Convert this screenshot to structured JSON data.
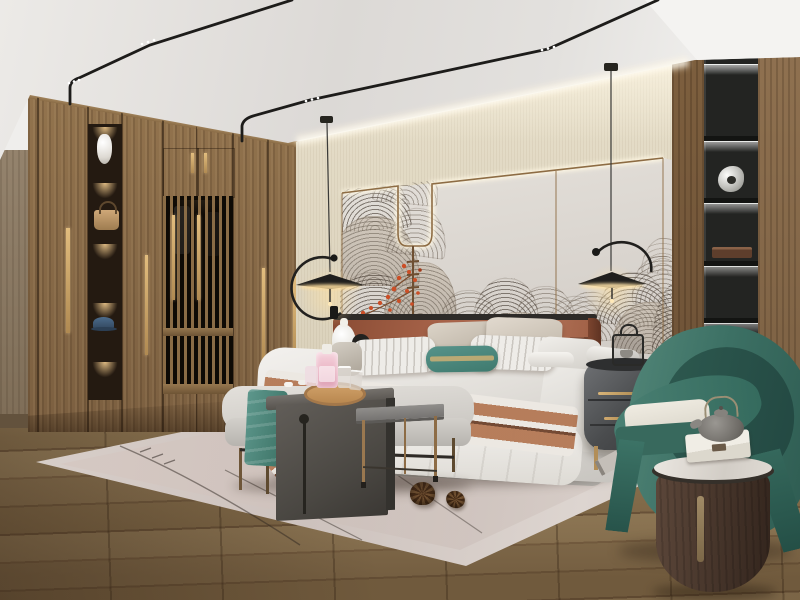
{
  "scene": {
    "title": "Modern Chinese style bedroom interior",
    "room": "bedroom",
    "style": "new Chinese / japandi",
    "lighting": "warm cove LED and black track lighting"
  },
  "objects": {
    "ceiling": {
      "label": "recessed white ceiling with black magnetic track lights"
    },
    "track_lighting": {
      "label": "thin black track lights with LED spots",
      "count": 2
    },
    "cove_light": {
      "label": "warm LED cove light above feature wall"
    },
    "wardrobe": {
      "label": "full-height walnut wardrobe wall",
      "handle_color": "#c9a96a"
    },
    "display_shelf": {
      "label": "red-backed display niches",
      "items": [
        "white ceramic vase",
        "tan leather handbag",
        "blue cap"
      ],
      "niche_count": 5
    },
    "lattice_doors": {
      "label": "wood lattice sliding doors with clothes behind"
    },
    "feature_wall": {
      "label": "cream padded wall panels with brass trim",
      "mural": "ink wave-cloud mural with red blossom sprigs",
      "panel_color": "#ddd8d2"
    },
    "pendant_lamp_left": {
      "label": "black disc pendant lamp with ring arm"
    },
    "pendant_lamp_right": {
      "label": "black disc pendant lamp with arc arm"
    },
    "bed": {
      "label": "upholstered platform bed with white duvet"
    },
    "headboard": {
      "label": "caramel leather panel headboard",
      "color": "#a8644a"
    },
    "pillows": {
      "label": "layered pillows",
      "accent_pillow_color": "#4f8a7e",
      "accent": "teal lumbar pillow with gold band"
    },
    "throw_runner": {
      "label": "caramel and white striped bed runner"
    },
    "nightstand_left": {
      "label": "black round nightstand"
    },
    "table_lamp": {
      "label": "white gourd ceramic lamp and small black lamp"
    },
    "nightstand_right": {
      "label": "gray oval nightstand with brass handles"
    },
    "lantern_decor": {
      "label": "black wire lantern ornament"
    },
    "bench": {
      "label": "light gray bed-end bench on bronze legs"
    },
    "teal_throw": {
      "label": "teal throw blanket"
    },
    "arch_side_table": {
      "label": "dark gray arch side table with cutout slot"
    },
    "tray_set": {
      "label": "round wood tray with pink perfume bottles and glasses"
    },
    "metal_side_table": {
      "label": "gray metal C-table with thin bronze legs"
    },
    "rug": {
      "label": "pale greige area rug with thin line motif"
    },
    "pinecones": {
      "label": "two pinecones on rug",
      "count": 2
    },
    "bookshelf": {
      "label": "black built-in display column with LED shelves",
      "items": [
        "silver sculpture",
        "dark wood box",
        "white books"
      ]
    },
    "armchair": {
      "label": "teal green barrel armchair with cream cushion",
      "color": "#3c7064"
    },
    "drum_table": {
      "label": "dark wood drum side table with marble top"
    },
    "teapot": {
      "label": "gray cast-iron teapot"
    },
    "gift_box": {
      "label": "white keepsake box"
    },
    "magazine": {
      "label": "magazine lying on floor"
    },
    "wood_floor": {
      "label": "wide-plank oak floor"
    },
    "left_wall": {
      "label": "wood side wall panel"
    }
  },
  "palette": {
    "wood": "#8a6f4e",
    "wall_beige": "#e3dcc9",
    "panel": "#ddd8d2",
    "teal_chair": "#3c7064",
    "caramel": "#a8644a",
    "rug": "#d3c9c4",
    "accent_red": "#cc4e26",
    "brass": "#c9a96a",
    "floor": "#8f7753",
    "shelf_black": "#232422"
  }
}
